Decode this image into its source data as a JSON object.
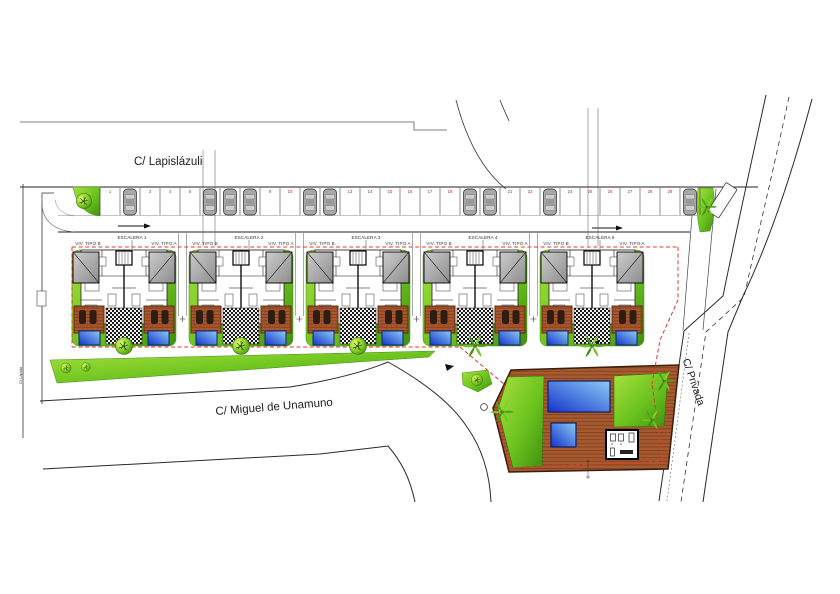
{
  "streets": {
    "top": "C/ Lapislázuli",
    "bottom": "C/ Miguel de Unamuno",
    "right": "C/ Privada",
    "left_small": "C/ Lápida"
  },
  "parking": {
    "stall_count": 30,
    "stall_numbers": [
      "1",
      "2",
      "3",
      "4",
      "5",
      "6",
      "7",
      "8",
      "9",
      "10",
      "11",
      "12",
      "13",
      "14",
      "15",
      "16",
      "17",
      "18",
      "19",
      "20",
      "21",
      "22",
      "23",
      "24",
      "25",
      "26",
      "27",
      "28",
      "29",
      "30"
    ],
    "occupied_stalls": [
      2,
      6,
      7,
      8,
      11,
      12,
      19,
      20,
      23,
      30
    ]
  },
  "blocks": [
    {
      "stair_label": "ESCALERA 1",
      "left_unit": "VIV. TIPO B",
      "right_unit": "VIV. TIPO A",
      "tree": "round"
    },
    {
      "stair_label": "ESCALERA 2",
      "left_unit": "VIV. TIPO B",
      "right_unit": "VIV. TIPO A",
      "tree": "round"
    },
    {
      "stair_label": "ESCALERA 3",
      "left_unit": "VIV. TIPO B",
      "right_unit": "VIV. TIPO A",
      "tree": "round"
    },
    {
      "stair_label": "ESCALERA 4",
      "left_unit": "VIV. TIPO B",
      "right_unit": "VIV. TIPO A",
      "tree": "palm"
    },
    {
      "stair_label": "ESCALERA 5",
      "left_unit": "VIV. TIPO B",
      "right_unit": "VIV. TIPO A",
      "tree": "palm"
    }
  ],
  "colors": {
    "lawn_green": "#6cc31e",
    "terrace_brown": "#a8582e",
    "pool_blue": "#1633cc",
    "boundary_red": "#e03a30",
    "stall_number_red": "#cf1f1f",
    "roof_gray": "#b0b0b0"
  }
}
